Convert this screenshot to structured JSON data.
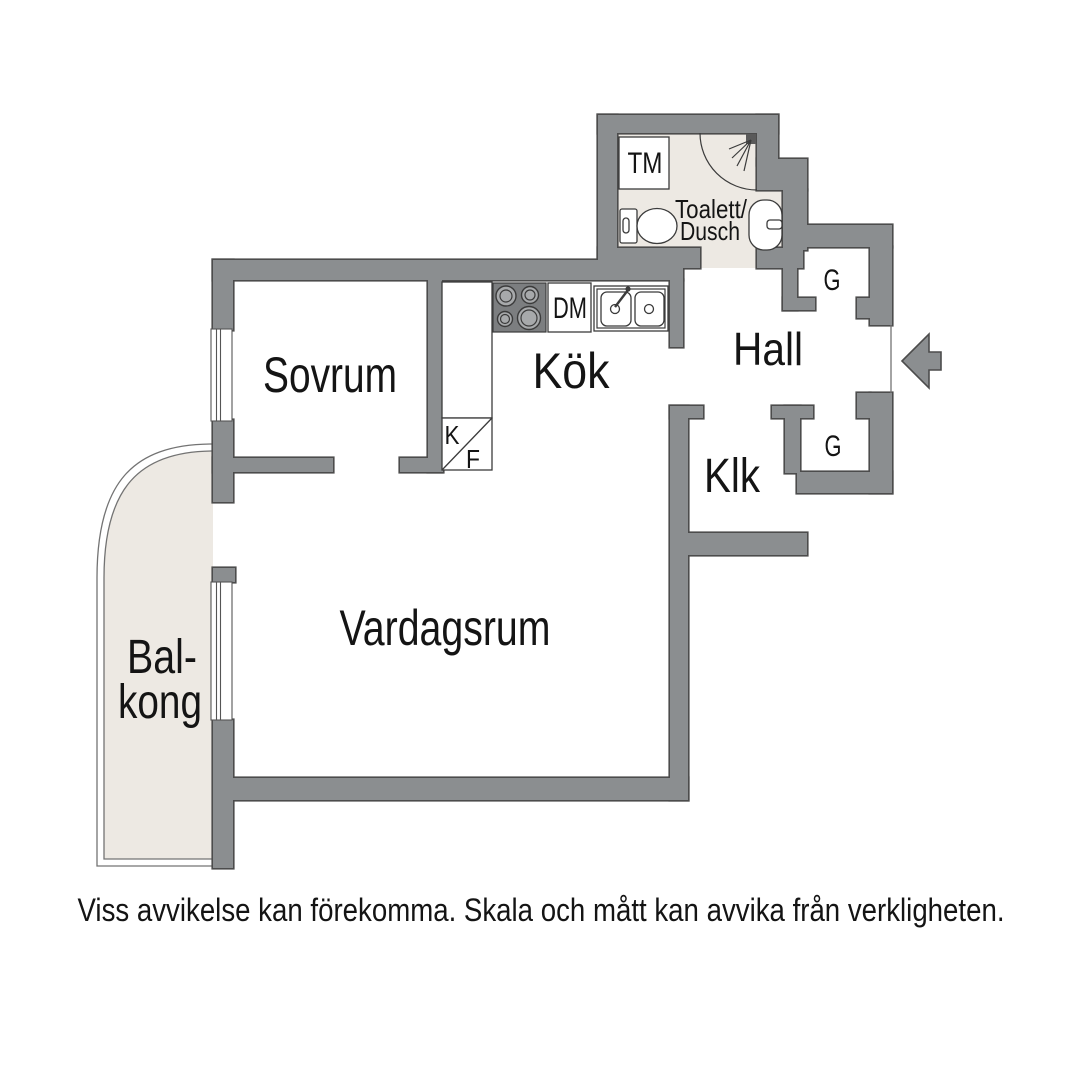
{
  "floorplan": {
    "room_labels": {
      "sovrum": "Sovrum",
      "kok": "Kök",
      "hall": "Hall",
      "klk": "Klk",
      "vardagsrum": "Vardagsrum",
      "balkong_line1": "Bal-",
      "balkong_line2": "kong",
      "toalett_line1": "Toalett/",
      "toalett_line2": "Dusch"
    },
    "fixture_labels": {
      "tm": "TM",
      "dm": "DM",
      "k": "K",
      "f": "F",
      "g_top": "G",
      "g_bottom": "G"
    }
  },
  "disclaimer": "Viss avvikelse kan förekomma. Skala och mått kan avvika från verkligheten.",
  "colors": {
    "wall": "#8b8e90",
    "wall_outline": "#4c4c4c",
    "floor_accent": "#ede9e3",
    "fixture_line": "#3b3b3b",
    "text": "#141414",
    "background": "#ffffff"
  }
}
